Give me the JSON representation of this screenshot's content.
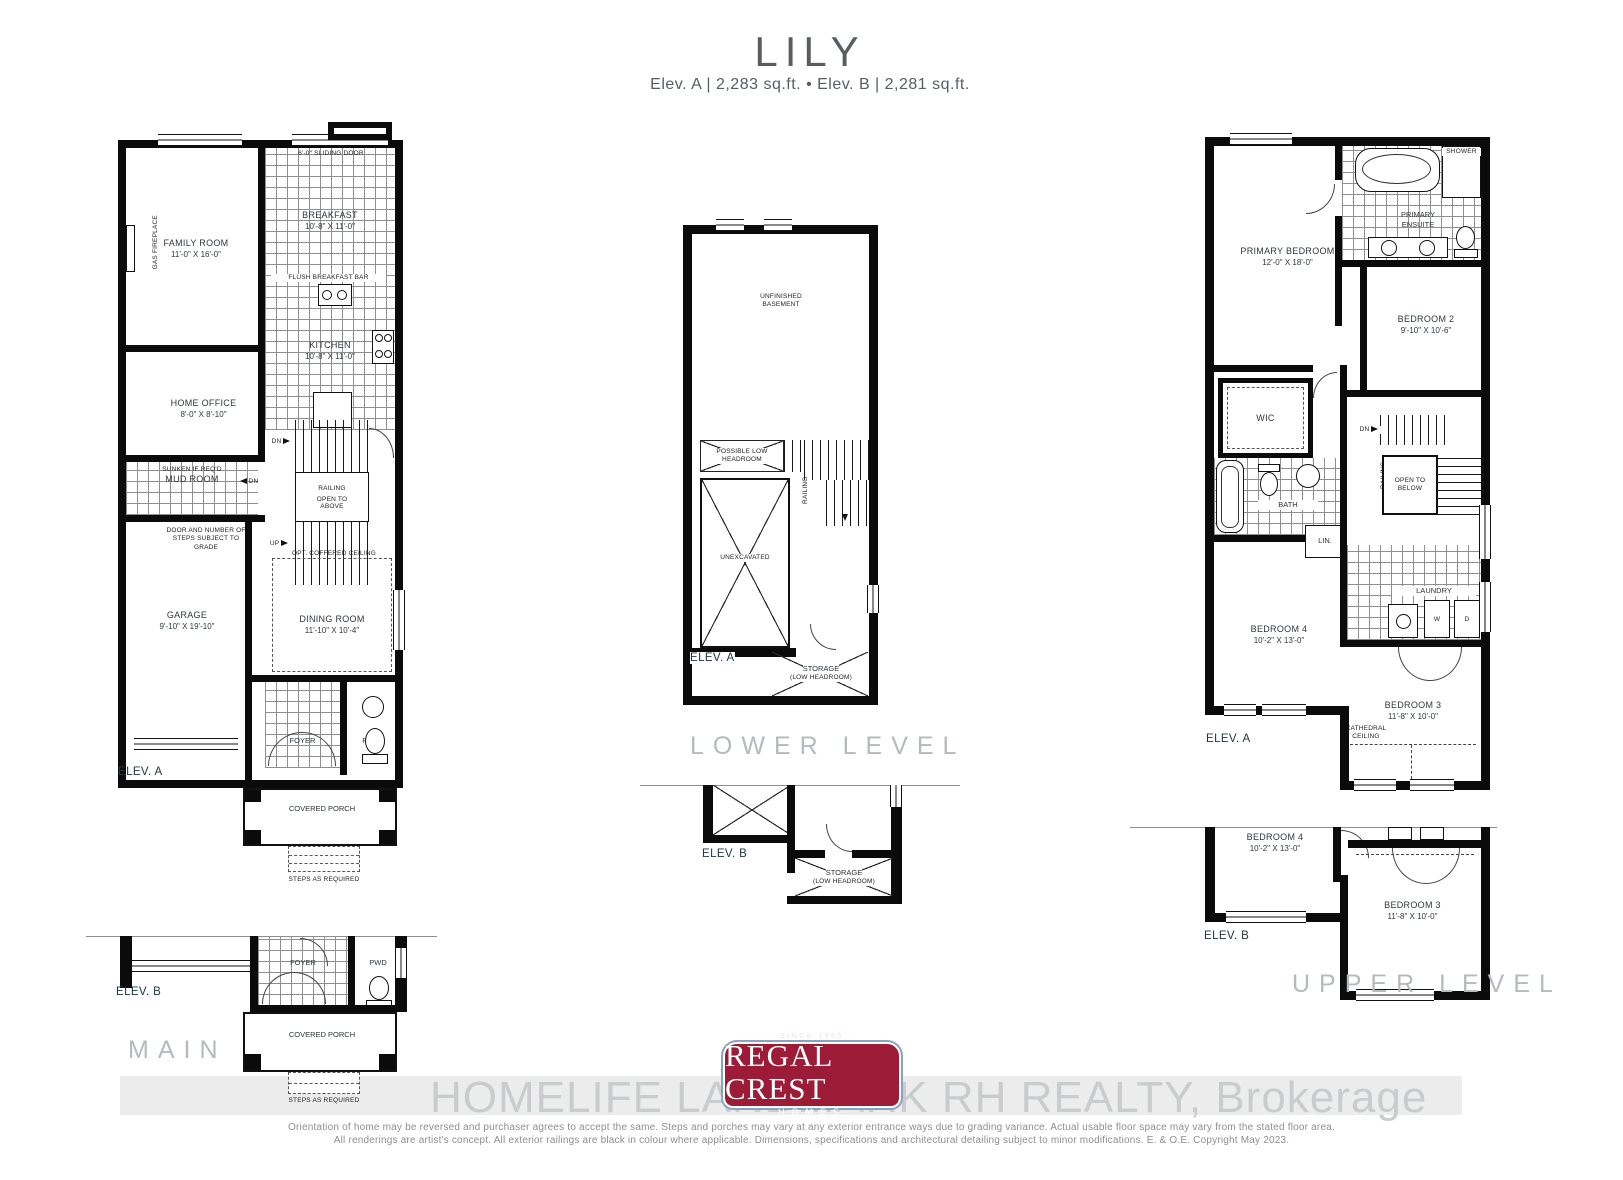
{
  "header": {
    "title": "LILY",
    "subtitle": "Elev. A  |  2,283 sq.ft.  •  Elev. B  |  2,281 sq.ft."
  },
  "common": {
    "elev_a": "ELEV. A",
    "elev_b": "ELEV. B",
    "railing": "RAILING",
    "dn": "DN",
    "up": "UP",
    "storage": "STORAGE",
    "low_headroom": "(LOW HEADROOM)",
    "steps_as_required": "STEPS AS REQUIRED",
    "covered_porch": "COVERED PORCH",
    "foyer": "FOYER",
    "pwd": "PWD"
  },
  "main_level": {
    "label": "MAIN LEVEL",
    "sliding_door": "6'-0\" SLIDING DOOR",
    "family_room": {
      "name": "FAMILY ROOM",
      "dims": "11'-0\" X 16'-0\""
    },
    "breakfast": {
      "name": "BREAKFAST",
      "dims": "10'-8\" X 11'-0\""
    },
    "kitchen": {
      "name": "KITCHEN",
      "dims": "10'-8\" X 11'-0\""
    },
    "flush_breakfast_bar": "FLUSH BREAKFAST BAR",
    "pantry": "PANTRY",
    "gas_fireplace": "GAS FIREPLACE",
    "home_office": {
      "name": "HOME OFFICE",
      "dims": "8'-0\" X 8'-10\""
    },
    "mud_room": {
      "prefix": "SUNKEN IF REQ'D",
      "name": "MUD ROOM"
    },
    "door_note": "DOOR AND NUMBER OF STEPS SUBJECT TO GRADE",
    "garage": {
      "name": "GARAGE",
      "dims": "9'-10\" X 19'-10\""
    },
    "dining_room": {
      "name": "DINING ROOM",
      "dims": "11'-10\" X 10'-4\""
    },
    "opt_coffered_ceiling": "OPT. COFFERED CEILING",
    "open_to_above": "OPEN TO ABOVE"
  },
  "lower_level": {
    "label": "LOWER LEVEL",
    "unfinished_basement": "UNFINISHED BASEMENT",
    "possible_low_headroom": "POSSIBLE LOW HEADROOM",
    "unexcavated": "UNEXCAVATED"
  },
  "upper_level": {
    "label": "UPPER LEVEL",
    "primary_bedroom": {
      "name": "PRIMARY BEDROOM",
      "dims": "12'-0\" X 18'-0\""
    },
    "primary_ensuite": "PRIMARY ENSUITE",
    "shower": "SHOWER",
    "bedroom_2": {
      "name": "BEDROOM 2",
      "dims": "9'-10\" X 10'-6\""
    },
    "wic": "WIC",
    "bath": "BATH",
    "lin": "LIN.",
    "open_to_below": "OPEN TO BELOW",
    "laundry": "LAUNDRY",
    "washer": "W",
    "dryer": "D",
    "bedroom_4": {
      "name": "BEDROOM 4",
      "dims": "10'-2\" X 13'-0\""
    },
    "bedroom_3": {
      "name": "BEDROOM 3",
      "dims": "11'-8\" X 10'-0\""
    },
    "cathedral_ceiling": "CATHEDRAL CEILING"
  },
  "footer": {
    "logo": {
      "since": "SINCE 1965",
      "name": "REGAL CREST",
      "homes": "HOMES"
    },
    "watermark": "HOMELIFE LANDMARK RH REALTY, Brokerage",
    "disclaimer_line1": "Orientation of home may be reversed and purchaser agrees to accept the same. Steps and porches may vary at any exterior entrance ways due to grading variance. Actual usable floor space may vary from the stated floor area.",
    "disclaimer_line2": "All renderings are artist's concept. All exterior railings are black in colour where applicable. Dimensions, specifications and architectural detailing subject to minor modifications. E. & O.E. Copyright May 2023."
  },
  "colors": {
    "wall_black": "#0b0b0b",
    "logo_red": "#9c1c38",
    "logo_border_blue": "#8aa3c0",
    "watermark_band": "#ececec",
    "watermark_text": "#c9cccd",
    "level_label_gray": "#b4babd",
    "elev_label": "#21383e"
  }
}
